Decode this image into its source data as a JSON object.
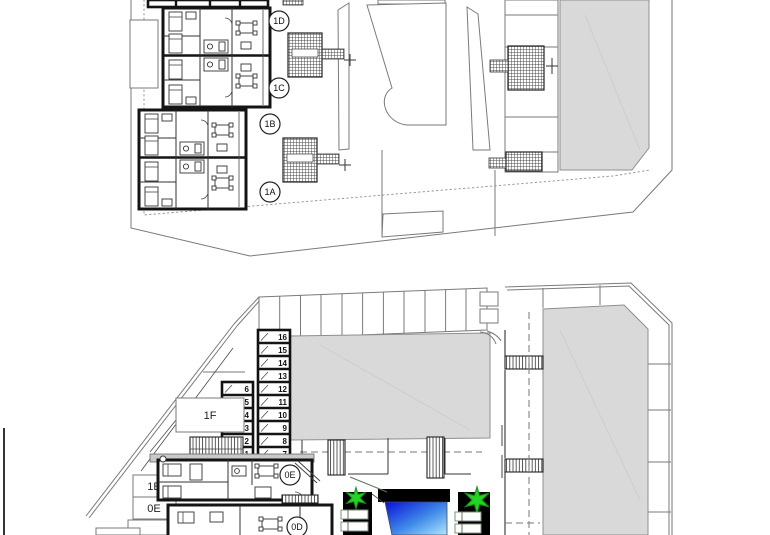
{
  "drawing": {
    "upper_plan": {
      "units": [
        {
          "label": "1D"
        },
        {
          "label": "1C"
        },
        {
          "label": "1B"
        },
        {
          "label": "1A"
        }
      ]
    },
    "lower_plan": {
      "area_boxes": [
        {
          "label": "1F"
        },
        {
          "label": "1E"
        },
        {
          "label": "0E"
        }
      ],
      "units": [
        {
          "label": "0E"
        },
        {
          "label": "0D"
        }
      ],
      "storage_right": [
        "16",
        "15",
        "14",
        "13",
        "12",
        "11",
        "10",
        "9",
        "8",
        "7"
      ],
      "storage_left": [
        "6",
        "5",
        "4",
        "3",
        "2",
        "1"
      ]
    },
    "colors": {
      "building_fill": "#d9d9d9",
      "landscape_green": "#24d324",
      "landscape_light": "#e3f3e0",
      "deck_yellow": "#e7c94d",
      "pool_dark": "#0a10d8",
      "pool_light": "#aee9fc"
    }
  }
}
